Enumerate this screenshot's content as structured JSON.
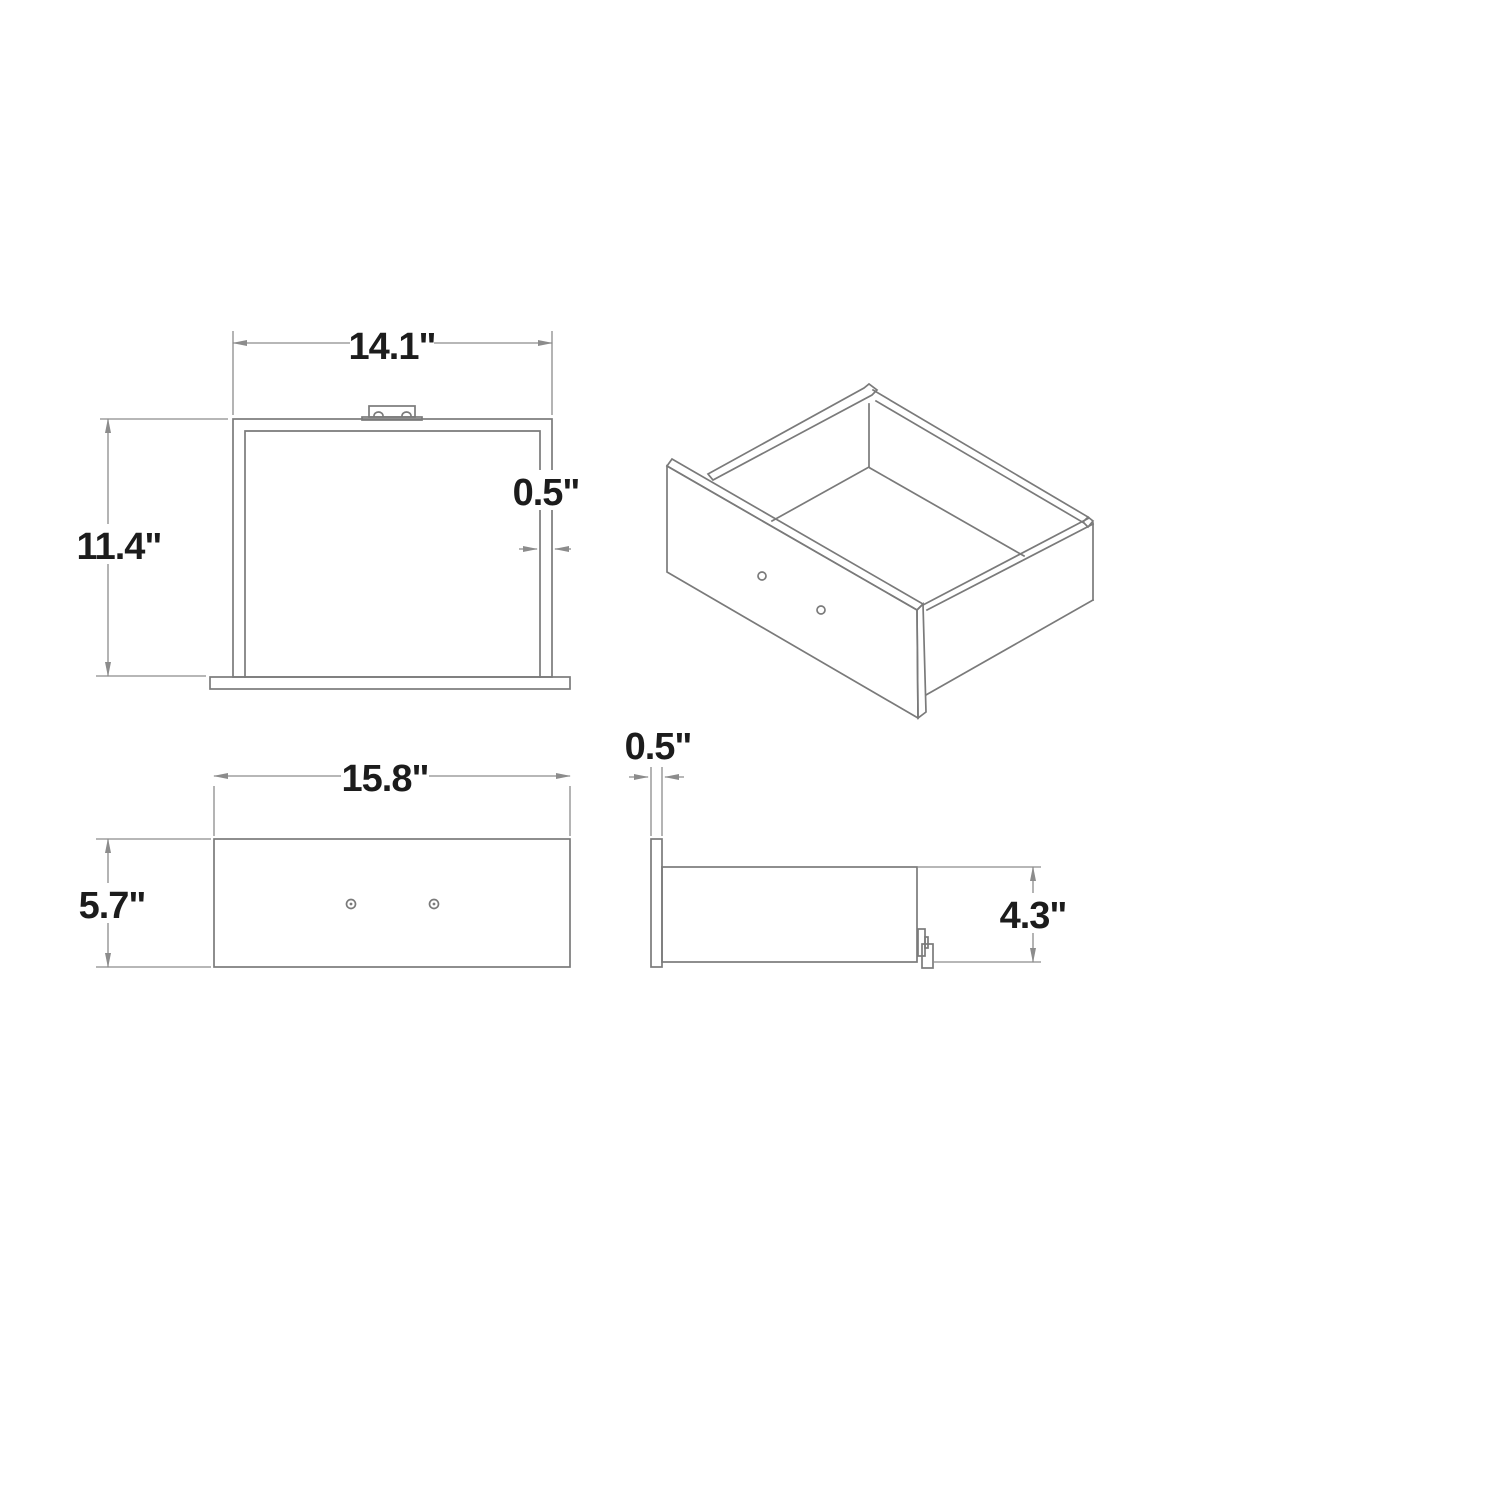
{
  "colors": {
    "bg": "#ffffff",
    "line": "#7a7a7a",
    "dim": "#8c8c8c",
    "text": "#1c1c1c"
  },
  "views": {
    "back": {
      "width": "14.1\"",
      "height": "11.4\"",
      "thickness": "0.5\""
    },
    "front": {
      "width": "15.8\"",
      "height": "5.7\""
    },
    "side": {
      "thickness": "0.5\"",
      "height": "4.3\""
    }
  }
}
